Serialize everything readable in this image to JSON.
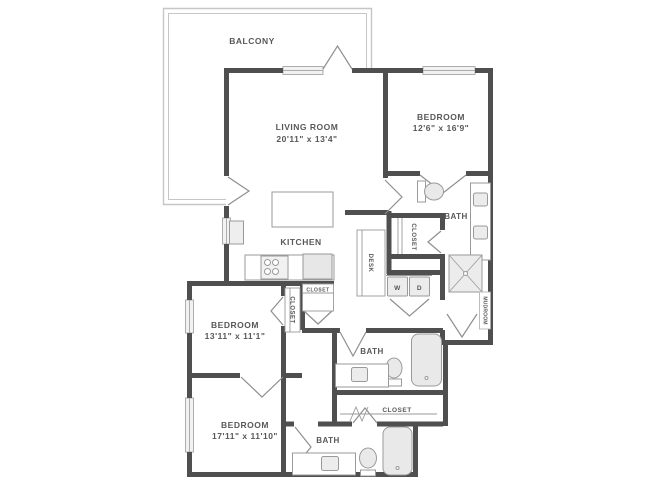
{
  "plan": {
    "labels": {
      "balcony": "BALCONY",
      "living_room": "LIVING ROOM",
      "living_room_dims": "20'11\" x 13'4\"",
      "bedroom_1": "BEDROOM",
      "bedroom_1_dims": "12'6\" x 16'9\"",
      "bath_1": "BATH",
      "closet_1": "CLOSET",
      "desk": "DESK",
      "washer": "W",
      "dryer": "D",
      "kitchen": "KITCHEN",
      "closet_2": "CLOSET",
      "closet_3": "CLOSET",
      "bedroom_2": "BEDROOM",
      "bedroom_2_dims": "13'11\" x 11'1\"",
      "bath_2": "BATH",
      "closet_4": "CLOSET",
      "bedroom_3": "BEDROOM",
      "bedroom_3_dims": "17'11\" x 11'10\"",
      "bath_3": "BATH",
      "mudroom": "MUDROOM"
    },
    "colors": {
      "wall": "#4f4f4f",
      "fixture_line": "#9a9a9a",
      "fixture_fill": "#ececec",
      "text": "#585858",
      "window_fill": "#f2f2f2",
      "balcony_line": "#c6c6c6"
    }
  }
}
